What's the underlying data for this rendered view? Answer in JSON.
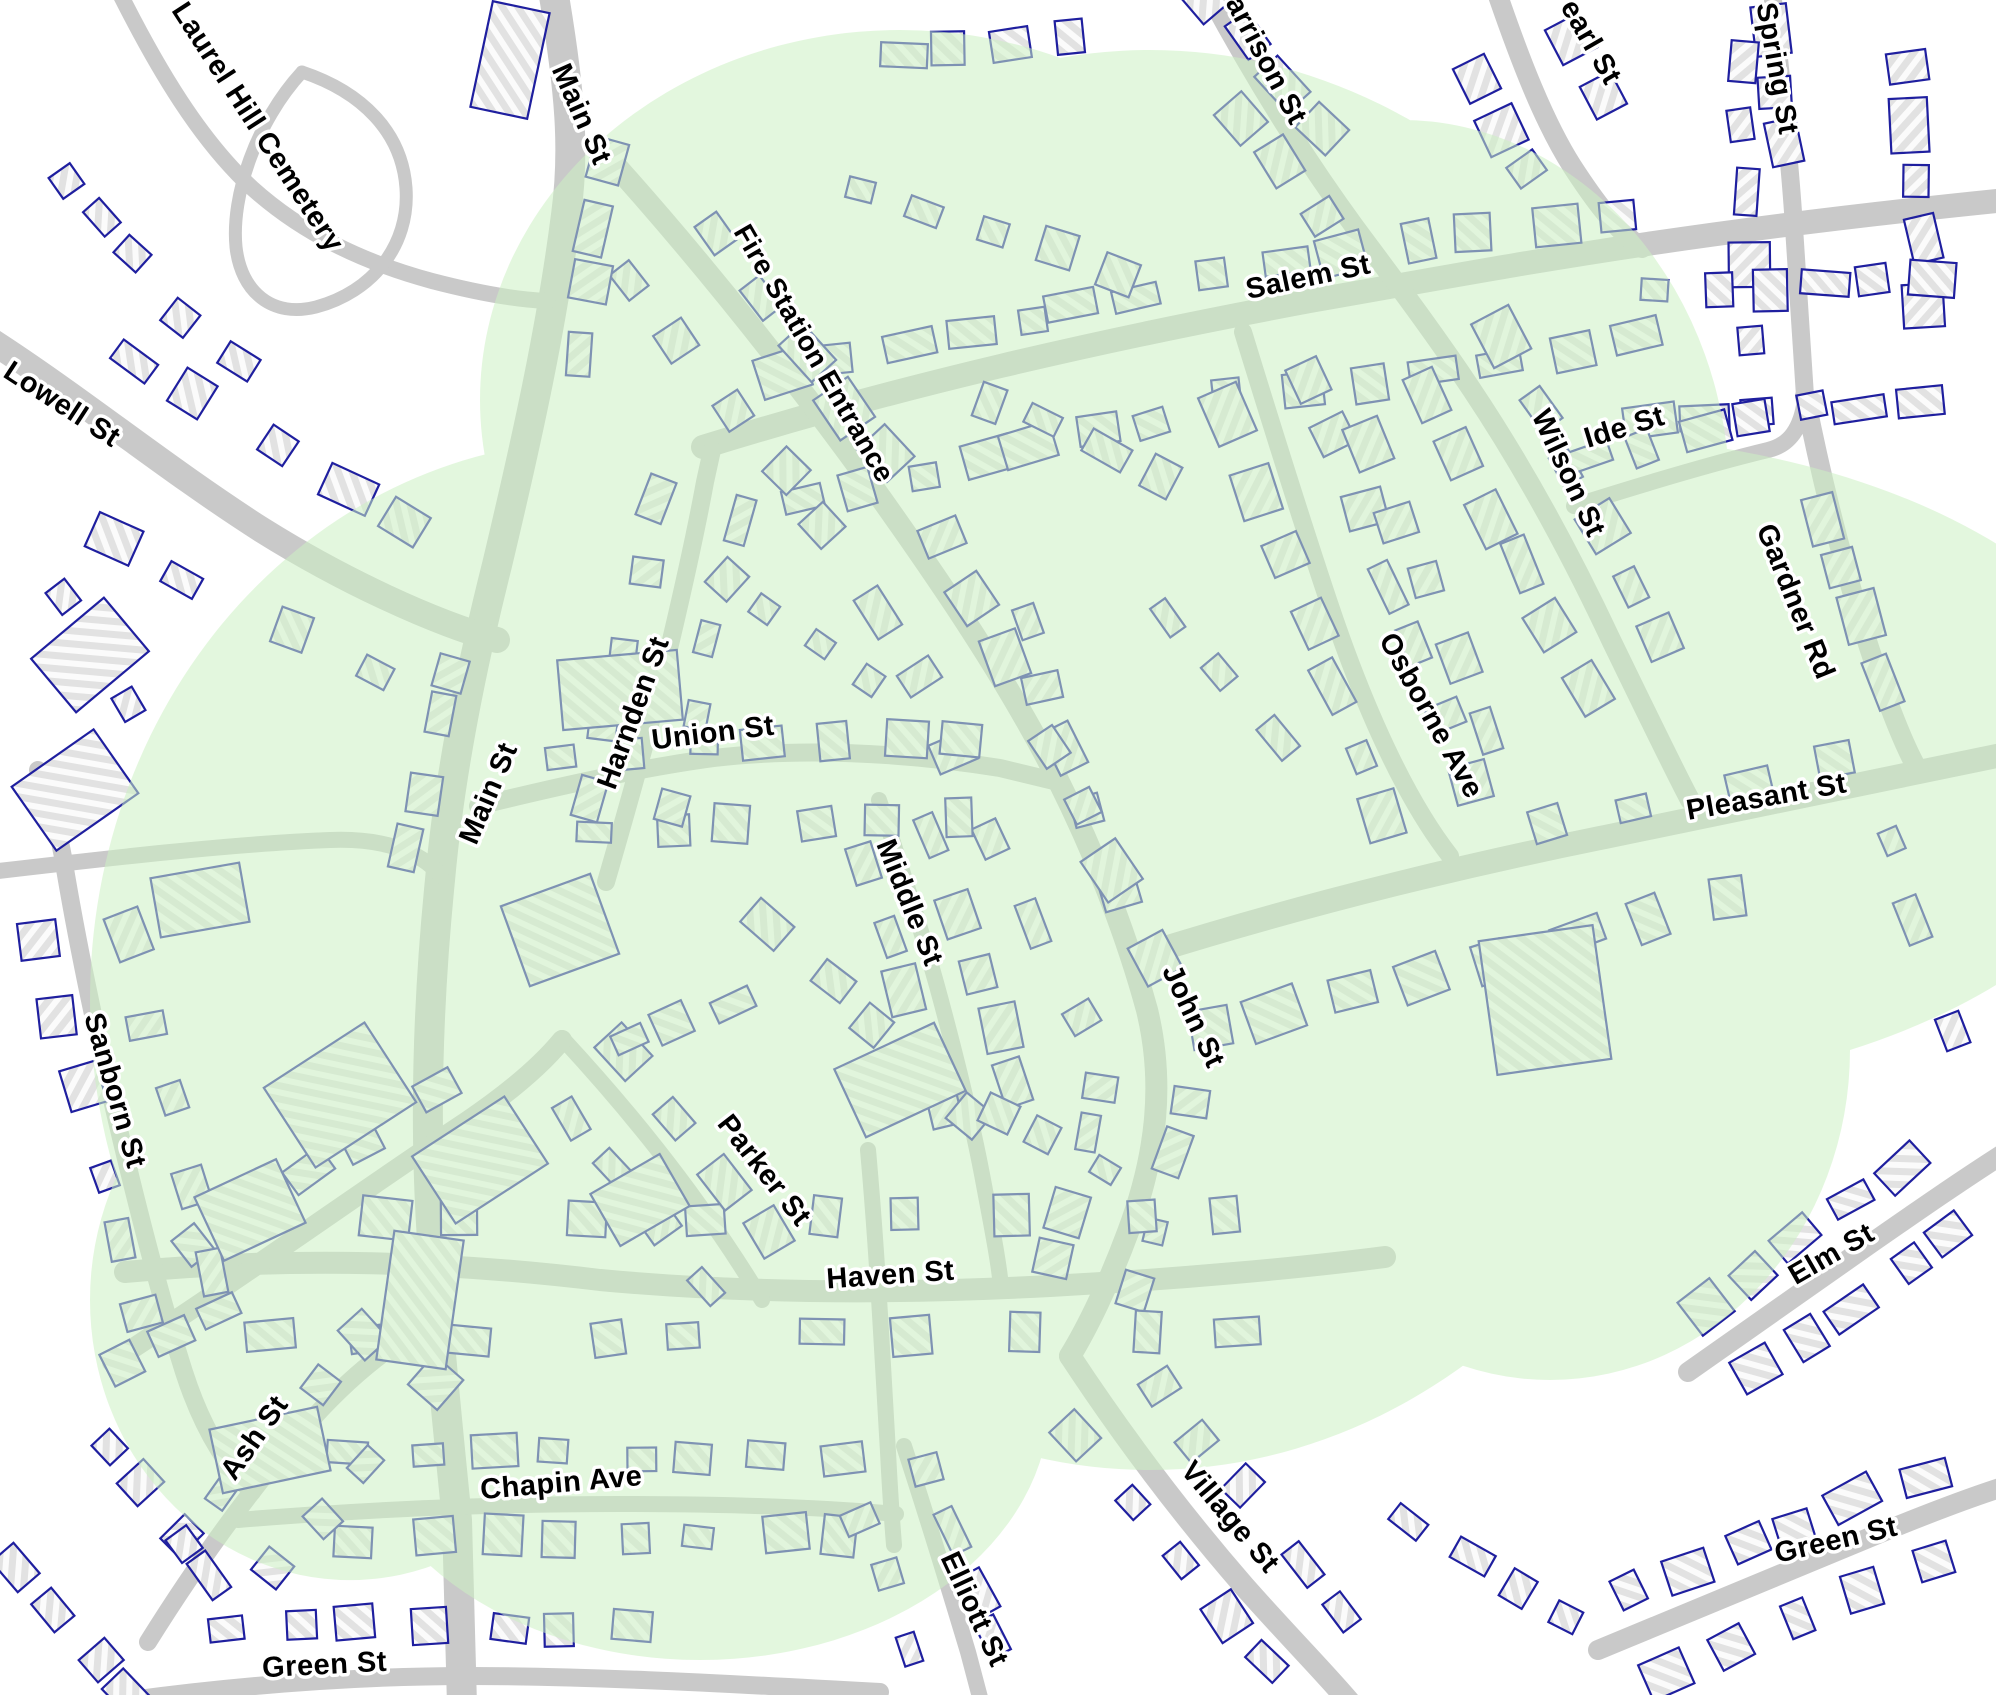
{
  "map": {
    "type": "street-map-with-coverage-overlay",
    "colors": {
      "background": "#ffffff",
      "road": "#c9c9c9",
      "building_fill": "#e2e2e2",
      "building_hatch": "#fbfbfb",
      "building_outline": "#1f1f9f",
      "coverage_fill": "#ccf0c3",
      "coverage_opacity": "0.55",
      "label_text": "#000000",
      "label_halo": "#ffffff"
    },
    "street_labels": [
      {
        "text": "Laurel Hill Cemetery",
        "x": 250,
        "y": 132,
        "rotate": 57,
        "size": 29
      },
      {
        "text": "Main St",
        "x": 573,
        "y": 118,
        "rotate": 66,
        "size": 29
      },
      {
        "text": "Fire Station Entrance",
        "x": 806,
        "y": 358,
        "rotate": 60,
        "size": 28
      },
      {
        "text": "Salem St",
        "x": 1310,
        "y": 286,
        "rotate": -12,
        "size": 29
      },
      {
        "text": "Harrison St",
        "x": 1253,
        "y": 55,
        "rotate": 62,
        "size": 29
      },
      {
        "text": "Pearl St",
        "x": 1578,
        "y": 38,
        "rotate": 60,
        "size": 29
      },
      {
        "text": "Spring St",
        "x": 1768,
        "y": 70,
        "rotate": 80,
        "size": 29
      },
      {
        "text": "Ide St",
        "x": 1627,
        "y": 436,
        "rotate": -17,
        "size": 29
      },
      {
        "text": "Wilson St",
        "x": 1560,
        "y": 477,
        "rotate": 65,
        "size": 29
      },
      {
        "text": "Gardner Rd",
        "x": 1787,
        "y": 605,
        "rotate": 68,
        "size": 29
      },
      {
        "text": "Lowell St",
        "x": 57,
        "y": 412,
        "rotate": 33,
        "size": 29
      },
      {
        "text": "Osborne Ave",
        "x": 1423,
        "y": 720,
        "rotate": 61,
        "size": 29
      },
      {
        "text": "Pleasant St",
        "x": 1768,
        "y": 806,
        "rotate": -10,
        "size": 29
      },
      {
        "text": "Harnden St",
        "x": 642,
        "y": 716,
        "rotate": -70,
        "size": 29
      },
      {
        "text": "Union St",
        "x": 714,
        "y": 742,
        "rotate": -7,
        "size": 29
      },
      {
        "text": "Main St",
        "x": 497,
        "y": 797,
        "rotate": -67,
        "size": 29
      },
      {
        "text": "Middle St",
        "x": 901,
        "y": 906,
        "rotate": 68,
        "size": 29
      },
      {
        "text": "John St",
        "x": 1185,
        "y": 1020,
        "rotate": 65,
        "size": 29
      },
      {
        "text": "Sanborn St",
        "x": 106,
        "y": 1093,
        "rotate": 74,
        "size": 29
      },
      {
        "text": "Parker St",
        "x": 757,
        "y": 1176,
        "rotate": 52,
        "size": 29
      },
      {
        "text": "Haven St",
        "x": 891,
        "y": 1284,
        "rotate": -4,
        "size": 29
      },
      {
        "text": "Ash St",
        "x": 262,
        "y": 1443,
        "rotate": -55,
        "size": 29
      },
      {
        "text": "Chapin Ave",
        "x": 562,
        "y": 1492,
        "rotate": -5,
        "size": 29
      },
      {
        "text": "Green St",
        "x": 325,
        "y": 1674,
        "rotate": -3,
        "size": 29
      },
      {
        "text": "Elliott St",
        "x": 966,
        "y": 1613,
        "rotate": 65,
        "size": 29
      },
      {
        "text": "Village St",
        "x": 1223,
        "y": 1523,
        "rotate": 50,
        "size": 29
      },
      {
        "text": "Green St",
        "x": 1838,
        "y": 1549,
        "rotate": -13,
        "size": 29
      },
      {
        "text": "Elm St",
        "x": 1836,
        "y": 1262,
        "rotate": -30,
        "size": 29
      }
    ]
  }
}
